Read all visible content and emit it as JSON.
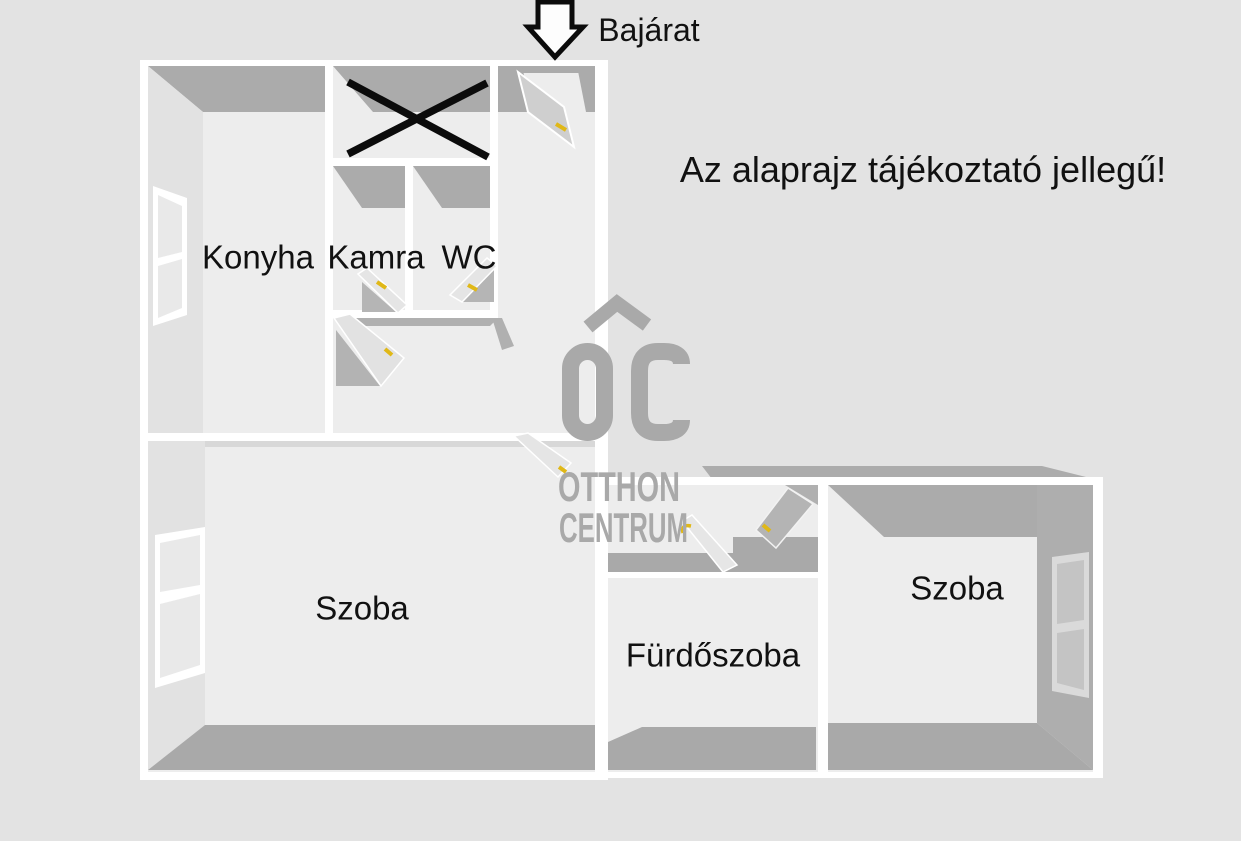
{
  "annotations": {
    "entrance": "Bajárat",
    "disclaimer": "Az alaprajz tájékoztató jellegű!"
  },
  "rooms": {
    "konyha": "Konyha",
    "kamra": "Kamra",
    "wc": "WC",
    "szoba_left": "Szoba",
    "furdoszoba": "Fürdőszoba",
    "szoba_right": "Szoba"
  },
  "watermark": {
    "logo_letters": "OC",
    "line1": "OTTHON",
    "line2": "CENTRUM"
  },
  "colors": {
    "background": "#e3e3e3",
    "wall_white": "#ffffff",
    "wall_shadow_gray": "#ababab",
    "room_fill": "#ededed",
    "floor_shadow": "#a9a9a9",
    "watermark_gray": "#a9a9a9",
    "door_handle_yellow": "#e0b817",
    "ink_black": "#111111"
  }
}
